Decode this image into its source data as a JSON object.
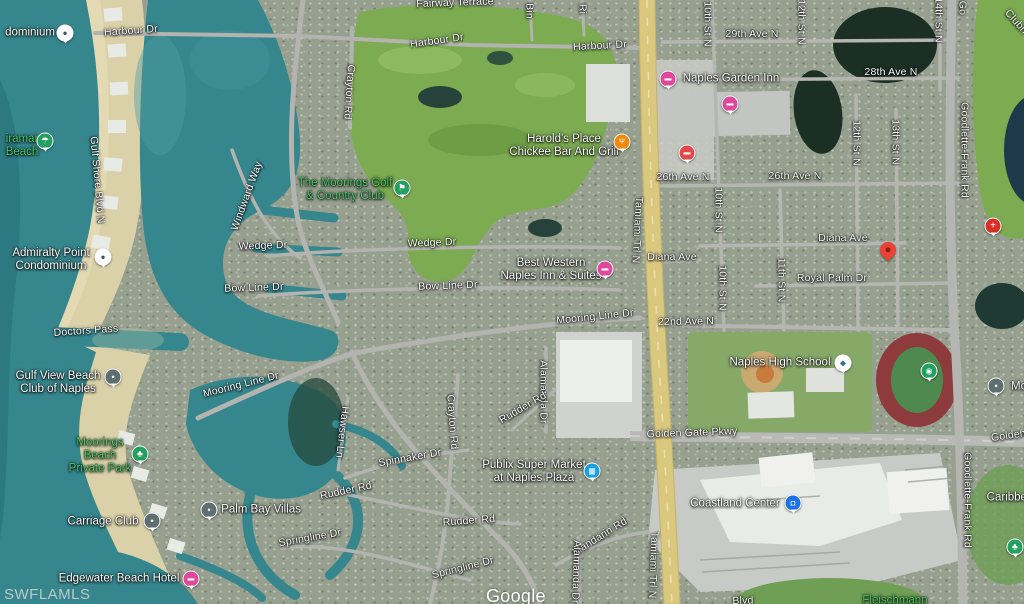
{
  "map": {
    "watermarks": {
      "mls": "SWFLAMLS",
      "google": "Google"
    },
    "colors": {
      "water": "#36868d",
      "sand": "#dbd1a9",
      "golf_green": "#7cab51",
      "road_gray": "#b3b3af",
      "highway_yellow": "#dbc87f",
      "park_label_green": "#4ec969",
      "lodging_pink": "#e0489e",
      "restaurant_orange": "#ef8a0e",
      "red_poi": "#e4484a",
      "hospital_red": "#d93025",
      "cart_blue": "#17a0e6",
      "bag_blue": "#1a73e8",
      "green_poi": "#21a05e",
      "gray_pin": "#5f6e70",
      "marker_red": "#ea4335"
    },
    "icon_glyphs": {
      "lodging": "▬",
      "restaurant": "Ψ",
      "red-poi": "▬",
      "hospital": "+",
      "golf": "⚑",
      "park": "♣",
      "tree": "♣",
      "beach": "☂",
      "sports": "◉",
      "cart": "▦",
      "bag": "◘",
      "school": "◆",
      "condo-pin": "●",
      "gray-pin": "●"
    },
    "destination_marker": {
      "x": 888,
      "y": 256
    },
    "street_labels": [
      {
        "t": "Fairway Terrace",
        "x": 455,
        "y": 3,
        "r": -2
      },
      {
        "t": "Harbour Dr",
        "x": 131,
        "y": 31,
        "r": -4
      },
      {
        "t": "Harbour Dr",
        "x": 437,
        "y": 41,
        "r": -8
      },
      {
        "t": "Harbour Dr",
        "x": 600,
        "y": 46,
        "r": -3
      },
      {
        "t": "Bin",
        "x": 529,
        "y": 11,
        "r": 90
      },
      {
        "t": "Ri",
        "x": 582,
        "y": 9,
        "r": 90
      },
      {
        "t": "10th St N",
        "x": 707,
        "y": 24,
        "r": 90
      },
      {
        "t": "12th St N",
        "x": 801,
        "y": 22,
        "r": 90
      },
      {
        "t": "14th St N",
        "x": 938,
        "y": 20,
        "r": 90
      },
      {
        "t": "Go",
        "x": 962,
        "y": 8,
        "r": 90
      },
      {
        "t": "Clubh",
        "x": 1016,
        "y": 22,
        "r": 48
      },
      {
        "t": "29th Ave N",
        "x": 752,
        "y": 34,
        "r": 0
      },
      {
        "t": "28th Ave N",
        "x": 891,
        "y": 72,
        "r": 0
      },
      {
        "t": "Crayton Rd",
        "x": 349,
        "y": 92,
        "r": 94
      },
      {
        "t": "Goodlette-Frank Rd",
        "x": 964,
        "y": 150,
        "r": 90
      },
      {
        "t": "26th Ave N",
        "x": 683,
        "y": 177,
        "r": 0
      },
      {
        "t": "26th Ave N",
        "x": 795,
        "y": 176,
        "r": 0
      },
      {
        "t": "Gulf Shore Blvd N",
        "x": 97,
        "y": 180,
        "r": 85
      },
      {
        "t": "Windward Way",
        "x": 247,
        "y": 196,
        "r": -70
      },
      {
        "t": "10th St N",
        "x": 718,
        "y": 210,
        "r": 90
      },
      {
        "t": "12th St N",
        "x": 856,
        "y": 143,
        "r": 90
      },
      {
        "t": "13th St N",
        "x": 895,
        "y": 142,
        "r": 90
      },
      {
        "t": "Tamiami Trl N",
        "x": 637,
        "y": 230,
        "r": 93
      },
      {
        "t": "Diana Ave",
        "x": 843,
        "y": 238,
        "r": 0
      },
      {
        "t": "Wedge Dr",
        "x": 432,
        "y": 243,
        "r": -2
      },
      {
        "t": "Wedge Dr",
        "x": 263,
        "y": 246,
        "r": -2
      },
      {
        "t": "Diana Ave",
        "x": 672,
        "y": 257,
        "r": 0
      },
      {
        "t": "Royal Palm Dr",
        "x": 832,
        "y": 278,
        "r": 0
      },
      {
        "t": "11th St N",
        "x": 781,
        "y": 280,
        "r": 90
      },
      {
        "t": "Bow Line Dr",
        "x": 448,
        "y": 286,
        "r": -2
      },
      {
        "t": "Bow Line Dr",
        "x": 254,
        "y": 288,
        "r": -2
      },
      {
        "t": "10th St N",
        "x": 722,
        "y": 288,
        "r": 90
      },
      {
        "t": "Mooring Line Dr",
        "x": 595,
        "y": 317,
        "r": -6
      },
      {
        "t": "22nd Ave N",
        "x": 686,
        "y": 322,
        "r": -1
      },
      {
        "t": "Doctors Pass",
        "x": 86,
        "y": 331,
        "r": -4
      },
      {
        "t": "Mooring Line Dr",
        "x": 241,
        "y": 385,
        "r": -14
      },
      {
        "t": "Alamanda Dr",
        "x": 543,
        "y": 392,
        "r": 90
      },
      {
        "t": "Rudder Rd",
        "x": 523,
        "y": 408,
        "r": -30
      },
      {
        "t": "Crayton Rd",
        "x": 452,
        "y": 422,
        "r": 86
      },
      {
        "t": "Hawser Ln",
        "x": 342,
        "y": 432,
        "r": 97
      },
      {
        "t": "Golden Gate Pkwy",
        "x": 692,
        "y": 433,
        "r": -2
      },
      {
        "t": "Golden Gate Pkwy",
        "x": 1036,
        "y": 432,
        "r": -8
      },
      {
        "t": "Spinnaker Dr",
        "x": 410,
        "y": 458,
        "r": -10
      },
      {
        "t": "Rudder Rd",
        "x": 346,
        "y": 491,
        "r": -12
      },
      {
        "t": "Goodlette-Frank Rd",
        "x": 967,
        "y": 500,
        "r": 90
      },
      {
        "t": "Rudder Rd",
        "x": 469,
        "y": 521,
        "r": -4
      },
      {
        "t": "Mandarin Rd",
        "x": 600,
        "y": 537,
        "r": -32
      },
      {
        "t": "Springline Dr",
        "x": 310,
        "y": 538,
        "r": -10
      },
      {
        "t": "Tamiami Trl N",
        "x": 653,
        "y": 565,
        "r": 92
      },
      {
        "t": "Springline Dr",
        "x": 463,
        "y": 568,
        "r": -14
      },
      {
        "t": "Alamanda Dr",
        "x": 576,
        "y": 572,
        "r": 92
      },
      {
        "t": "Blvd",
        "x": 743,
        "y": 601,
        "r": -2
      }
    ],
    "place_labels": [
      {
        "lines": [
          "dominium"
        ],
        "x": 30,
        "y": 33,
        "green": false
      },
      {
        "lines": [
          "Naples Garden Inn"
        ],
        "x": 731,
        "y": 79,
        "green": false
      },
      {
        "lines": [
          "iramar",
          "Beach"
        ],
        "x": 22,
        "y": 146,
        "green": true
      },
      {
        "lines": [
          "Harold's Place",
          "Chickee Bar And Grill"
        ],
        "x": 564,
        "y": 146,
        "green": false
      },
      {
        "lines": [
          "The Moorings Golf",
          "& Country Club"
        ],
        "x": 345,
        "y": 190,
        "green": true
      },
      {
        "lines": [
          "Admiralty Point",
          "Condominium"
        ],
        "x": 51,
        "y": 260,
        "green": false
      },
      {
        "lines": [
          "Best Western",
          "Naples Inn & Suites"
        ],
        "x": 551,
        "y": 270,
        "green": false
      },
      {
        "lines": [
          "Naples High School"
        ],
        "x": 780,
        "y": 363,
        "green": false
      },
      {
        "lines": [
          "Gulf View Beach",
          "Club of Naples"
        ],
        "x": 58,
        "y": 383,
        "green": false
      },
      {
        "lines": [
          "Mo"
        ],
        "x": 1019,
        "y": 387,
        "green": false
      },
      {
        "lines": [
          "Moorings",
          "Beach",
          "Private Park"
        ],
        "x": 100,
        "y": 456,
        "green": true
      },
      {
        "lines": [
          "Publix Super Market",
          "at Naples Plaza"
        ],
        "x": 534,
        "y": 472,
        "green": false
      },
      {
        "lines": [
          "Caribbea"
        ],
        "x": 1010,
        "y": 498,
        "green": false
      },
      {
        "lines": [
          "Coastland Center"
        ],
        "x": 735,
        "y": 504,
        "green": false
      },
      {
        "lines": [
          "Palm Bay Villas"
        ],
        "x": 261,
        "y": 510,
        "green": false
      },
      {
        "lines": [
          "Carriage Club"
        ],
        "x": 103,
        "y": 522,
        "green": false
      },
      {
        "lines": [
          "Edgewater Beach Hotel"
        ],
        "x": 119,
        "y": 579,
        "green": false
      },
      {
        "lines": [
          "Fleischmann"
        ],
        "x": 895,
        "y": 601,
        "green": true
      }
    ],
    "poi_icons": [
      {
        "type": "condo-pin",
        "x": 65,
        "y": 33
      },
      {
        "type": "lodging",
        "x": 668,
        "y": 79
      },
      {
        "type": "lodging",
        "x": 730,
        "y": 104
      },
      {
        "type": "beach",
        "x": 45,
        "y": 141
      },
      {
        "type": "restaurant",
        "x": 622,
        "y": 142
      },
      {
        "type": "red-poi",
        "x": 687,
        "y": 153
      },
      {
        "type": "golf",
        "x": 402,
        "y": 188
      },
      {
        "type": "hospital",
        "x": 993,
        "y": 226
      },
      {
        "type": "condo-pin",
        "x": 103,
        "y": 257
      },
      {
        "type": "lodging",
        "x": 605,
        "y": 269
      },
      {
        "type": "school",
        "x": 843,
        "y": 363
      },
      {
        "type": "sports",
        "x": 929,
        "y": 371
      },
      {
        "type": "gray-pin",
        "x": 113,
        "y": 377
      },
      {
        "type": "gray-pin",
        "x": 996,
        "y": 386
      },
      {
        "type": "park",
        "x": 140,
        "y": 454
      },
      {
        "type": "cart",
        "x": 592,
        "y": 471
      },
      {
        "type": "bag",
        "x": 793,
        "y": 503
      },
      {
        "type": "gray-pin",
        "x": 209,
        "y": 510
      },
      {
        "type": "gray-pin",
        "x": 152,
        "y": 521
      },
      {
        "type": "tree",
        "x": 1015,
        "y": 547
      },
      {
        "type": "lodging",
        "x": 191,
        "y": 579
      }
    ]
  }
}
